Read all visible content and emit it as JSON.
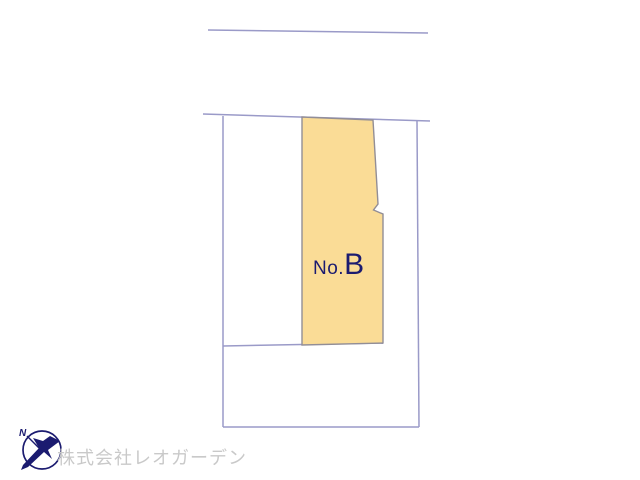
{
  "colors": {
    "background": "#ffffff",
    "boundary_line": "#9a9ac8",
    "plot_fill": "#fadc96",
    "plot_outline": "#928e96",
    "navy": "#1b1b70",
    "watermark": "#c9c9c9"
  },
  "plan": {
    "plot_label_prefix": "No.",
    "plot_label_letter": "B"
  },
  "logo": {
    "north_label": "N"
  },
  "footer": {
    "company_name": "株式会社レオガーデン"
  }
}
